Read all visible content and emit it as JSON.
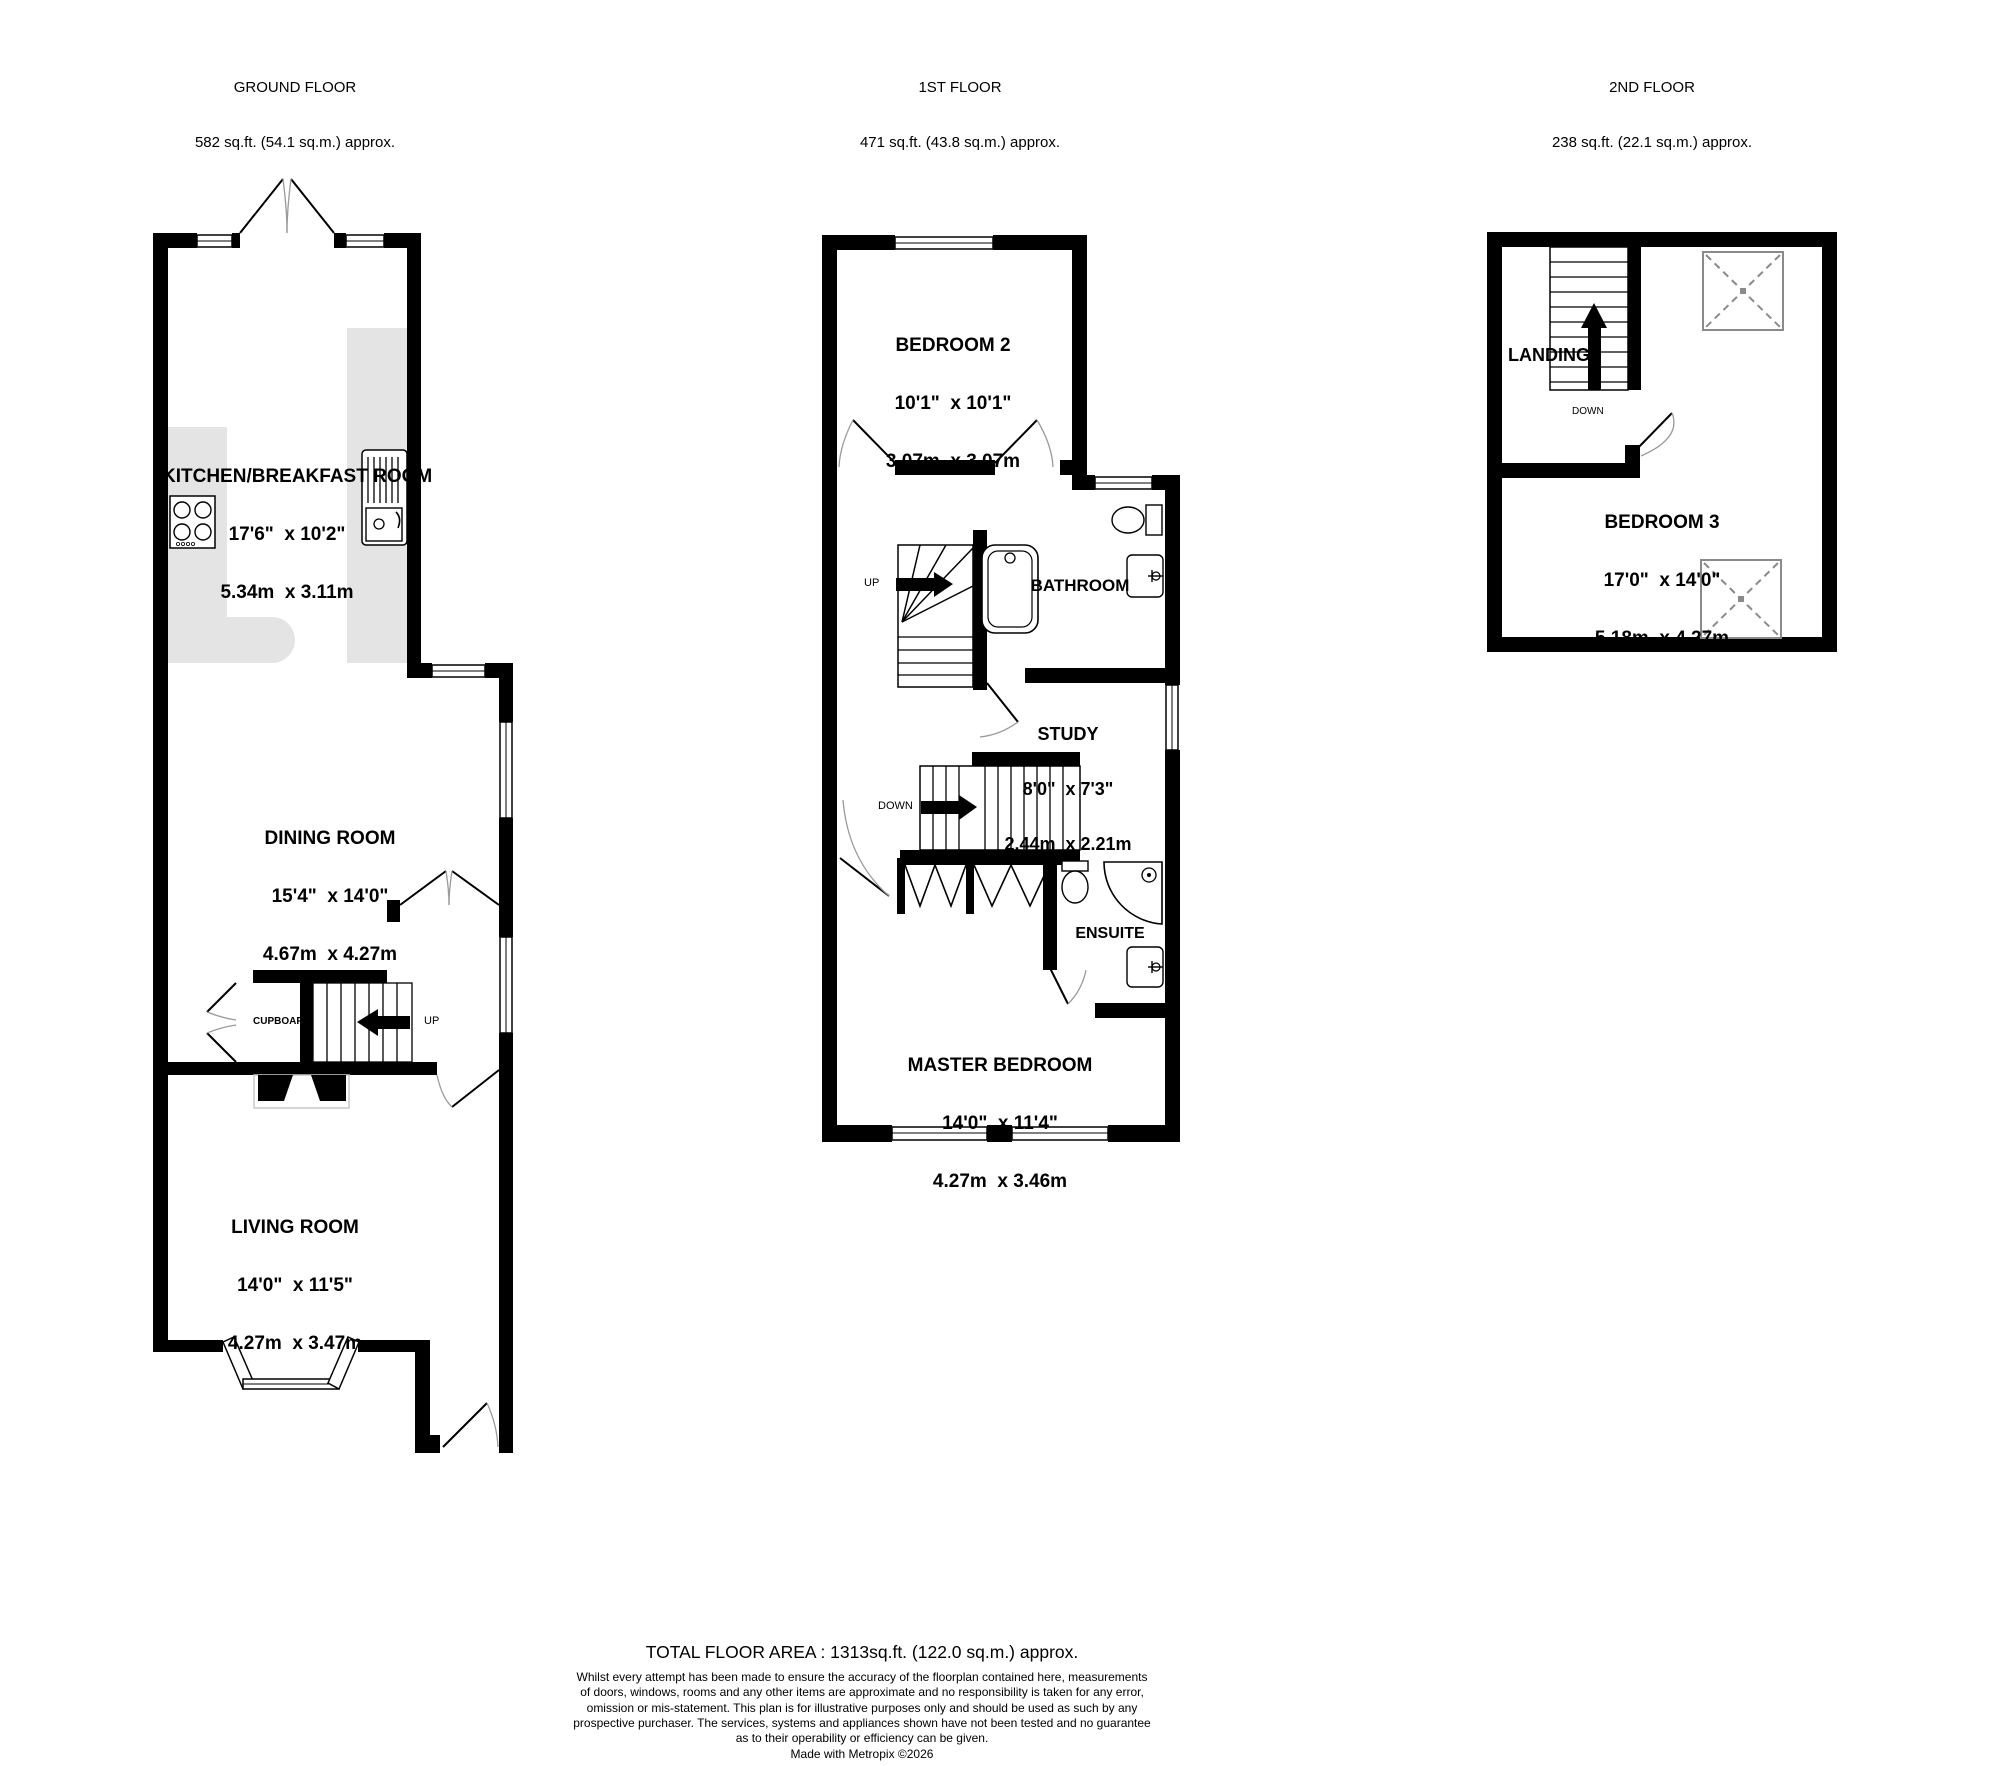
{
  "floors": {
    "ground": {
      "header_title": "GROUND FLOOR",
      "header_area": "582 sq.ft. (54.1 sq.m.) approx.",
      "rooms": {
        "kitchen": {
          "name": "KITCHEN/BREAKFAST ROOM",
          "imperial": "17'6\"  x 10'2\"",
          "metric": "5.34m  x 3.11m"
        },
        "dining": {
          "name": "DINING ROOM",
          "imperial": "15'4\"  x 14'0\"",
          "metric": "4.67m  x 4.27m"
        },
        "living": {
          "name": "LIVING ROOM",
          "imperial": "14'0\"  x 11'5\"",
          "metric": "4.27m  x 3.47m"
        }
      },
      "labels": {
        "cupboard": "CUPBOARD",
        "up": "UP"
      }
    },
    "first": {
      "header_title": "1ST FLOOR",
      "header_area": "471 sq.ft. (43.8 sq.m.) approx.",
      "rooms": {
        "bedroom2": {
          "name": "BEDROOM 2",
          "imperial": "10'1\"  x 10'1\"",
          "metric": "3.07m  x 3.07m"
        },
        "bathroom": {
          "name": "BATHROOM"
        },
        "study": {
          "name": "STUDY",
          "imperial": "8'0\"  x 7'3\"",
          "metric": "2.44m  x 2.21m"
        },
        "ensuite": {
          "name": "ENSUITE"
        },
        "master": {
          "name": "MASTER BEDROOM",
          "imperial": "14'0\"  x 11'4\"",
          "metric": "4.27m  x 3.46m"
        }
      },
      "labels": {
        "up": "UP",
        "down": "DOWN"
      }
    },
    "second": {
      "header_title": "2ND FLOOR",
      "header_area": "238 sq.ft. (22.1 sq.m.) approx.",
      "rooms": {
        "landing": {
          "name": "LANDING"
        },
        "bedroom3": {
          "name": "BEDROOM 3",
          "imperial": "17'0\"  x 14'0\"",
          "metric": "5.18m  x 4.27m"
        }
      },
      "labels": {
        "down": "DOWN"
      }
    }
  },
  "footer": {
    "total": "TOTAL FLOOR AREA : 1313sq.ft. (122.0 sq.m.) approx.",
    "disclaimer_lines": [
      "Whilst every attempt has been made to ensure the accuracy of the floorplan contained here, measurements",
      "of doors, windows, rooms and any other items are approximate and no responsibility is taken for any error,",
      "omission or mis-statement. This plan is for illustrative purposes only and should be used as such by any",
      "prospective purchaser. The services, systems and appliances shown have not been tested and no guarantee",
      "as to their operability or efficiency can be given."
    ],
    "credit": "Made with Metropix ©2026"
  },
  "colors": {
    "wall": "#000000",
    "counter": "#e4e4e4",
    "arc": "#9a9a9a",
    "skylight": "#8a8a8a"
  }
}
